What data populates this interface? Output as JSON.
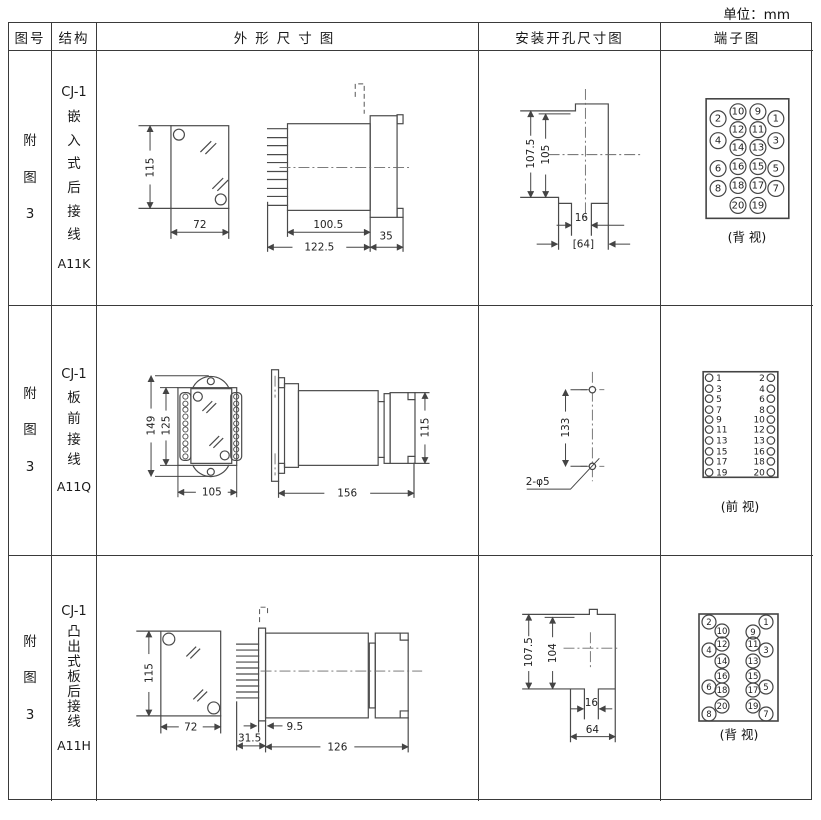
{
  "unit_label": "单位：mm",
  "header": {
    "figure": "图号",
    "structure": "结构",
    "outline": "外形尺寸图",
    "mounting": "安装开孔尺寸图",
    "terminal": "端子图"
  },
  "rows": [
    {
      "figure": "附图3",
      "structure": {
        "model": "CJ-1",
        "type": "嵌入式后接线",
        "code": "A11K"
      },
      "outline": {
        "height": "115",
        "width": "72",
        "depth_body": "100.5",
        "depth_total": "122.5",
        "flange": "35"
      },
      "mounting": {
        "outer": "107.5",
        "inner": "105",
        "slot": "16",
        "width": "[64]"
      },
      "terminal": {
        "caption": "(背 视)",
        "outer_left": [
          "2",
          "4",
          "6",
          "8"
        ],
        "inner_left": [
          "10",
          "12",
          "14",
          "16",
          "18",
          "20"
        ],
        "inner_right": [
          "9",
          "11",
          "13",
          "15",
          "17",
          "19"
        ],
        "outer_right": [
          "1",
          "3",
          "5",
          "7"
        ]
      }
    },
    {
      "figure": "附图3",
      "structure": {
        "model": "CJ-1",
        "type": "板前接线",
        "code": "A11Q"
      },
      "outline": {
        "outer_height": "149",
        "inner_height": "125",
        "width": "105",
        "depth": "156",
        "side_height": "115"
      },
      "mounting": {
        "spacing": "133",
        "holes": "2-φ5"
      },
      "terminal": {
        "caption": "(前 视)",
        "left": [
          "1",
          "3",
          "5",
          "7",
          "9",
          "11",
          "13",
          "15",
          "17",
          "19"
        ],
        "right": [
          "2",
          "4",
          "6",
          "8",
          "10",
          "12",
          "13",
          "16",
          "18",
          "20"
        ]
      }
    },
    {
      "figure": "附图3",
      "structure": {
        "model": "CJ-1",
        "type": "凸出式板后接线",
        "code": "A11H"
      },
      "outline": {
        "height": "115",
        "width": "72",
        "pin_len": "31.5",
        "gap": "9.5",
        "depth": "126"
      },
      "mounting": {
        "outer": "107.5",
        "inner": "104",
        "slot": "16",
        "width": "64"
      },
      "terminal": {
        "caption": "(背 视)",
        "outer_left": [
          "2",
          "4",
          "6",
          "8"
        ],
        "inner_left": [
          "10",
          "12",
          "14",
          "16",
          "18",
          "20"
        ],
        "inner_right": [
          "9",
          "11",
          "13",
          "15",
          "17",
          "19"
        ],
        "outer_right": [
          "1",
          "3",
          "5",
          "7"
        ]
      }
    }
  ]
}
